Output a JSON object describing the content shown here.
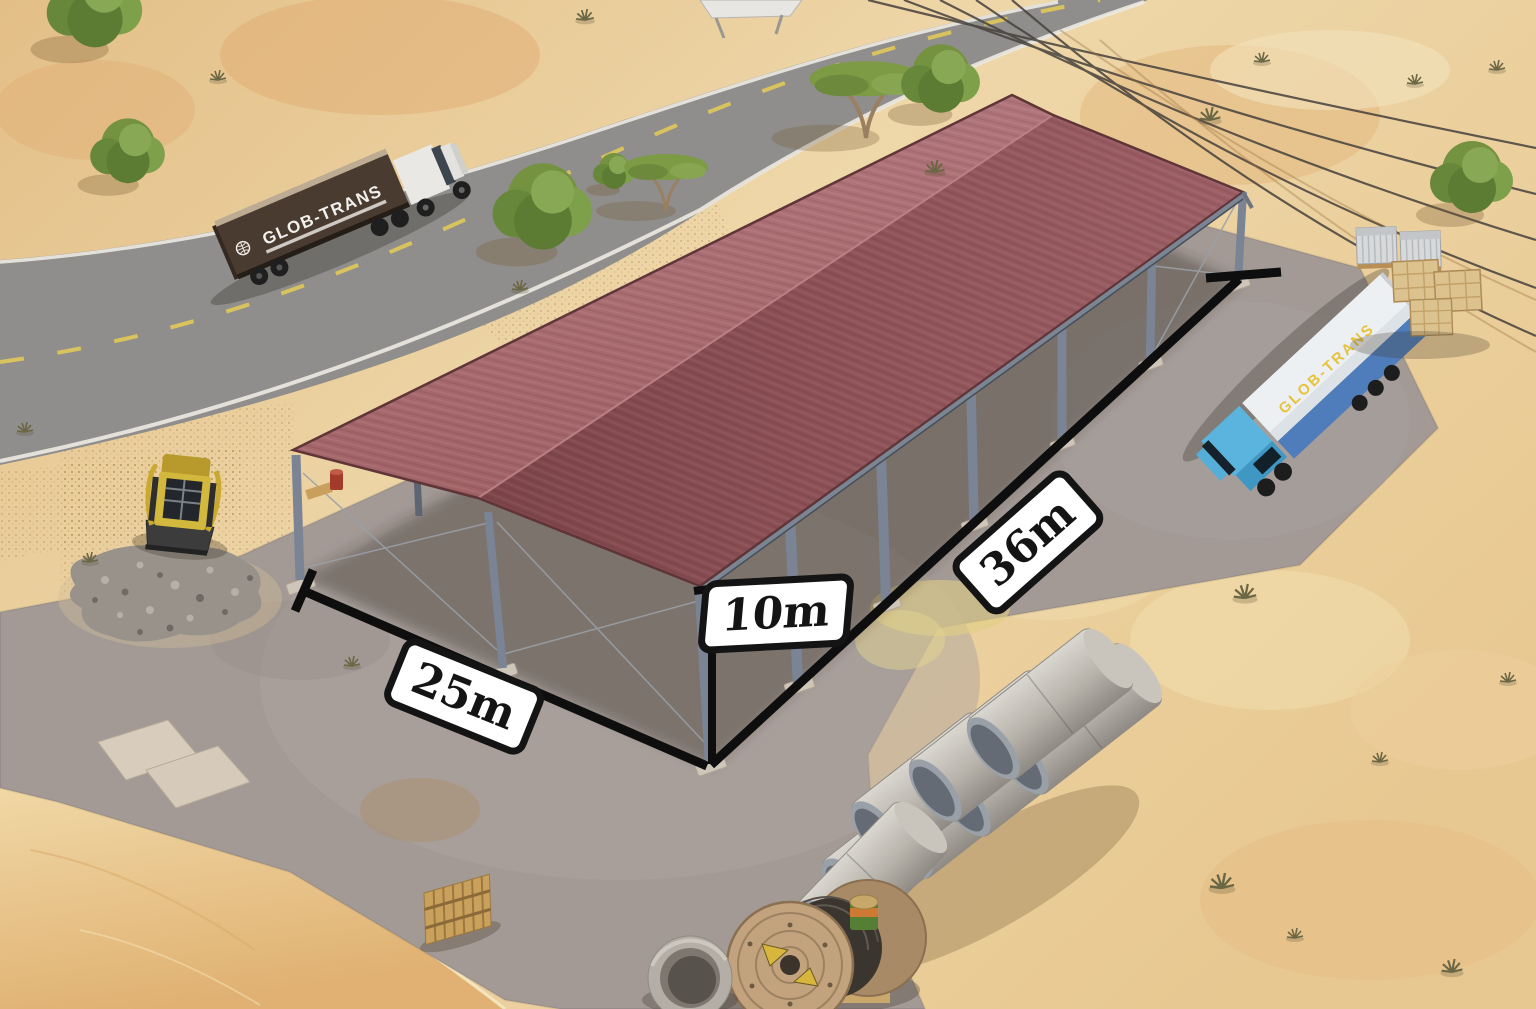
{
  "dimensions": {
    "width": "25m",
    "height": "10m",
    "length": "36m"
  },
  "branding": {
    "road_truck_logo": "GLOB-TRANS",
    "parked_truck_logo": "GLOB-TRANS"
  },
  "colors": {
    "sand_base": "#ecd2a0",
    "dune": "#e5b878",
    "asphalt": "#8f8e8c",
    "lane_yellow": "#d9c35e",
    "road_edge": "#eceae2",
    "concrete": "#a39a96",
    "steel": "#7b8494",
    "steel_dark": "#5d6572",
    "roof_left": "#aa6b6f",
    "roof_right": "#8c4f55",
    "roof_edge": "#5f3538",
    "label_bg": "#ffffff",
    "label_border": "#141414",
    "cab_blue": "#5ab4dd",
    "trailer_blue": "#4f7cba",
    "trailer_brown": "#4a3b31",
    "cab_white": "#e9e8e5",
    "logo_yellow": "#e6c33c",
    "pipe_concrete": "#c9c5bd",
    "reel_wood": "#c2a37e",
    "foliage": "#74923f",
    "dimension_line": "#0e0e0e"
  }
}
